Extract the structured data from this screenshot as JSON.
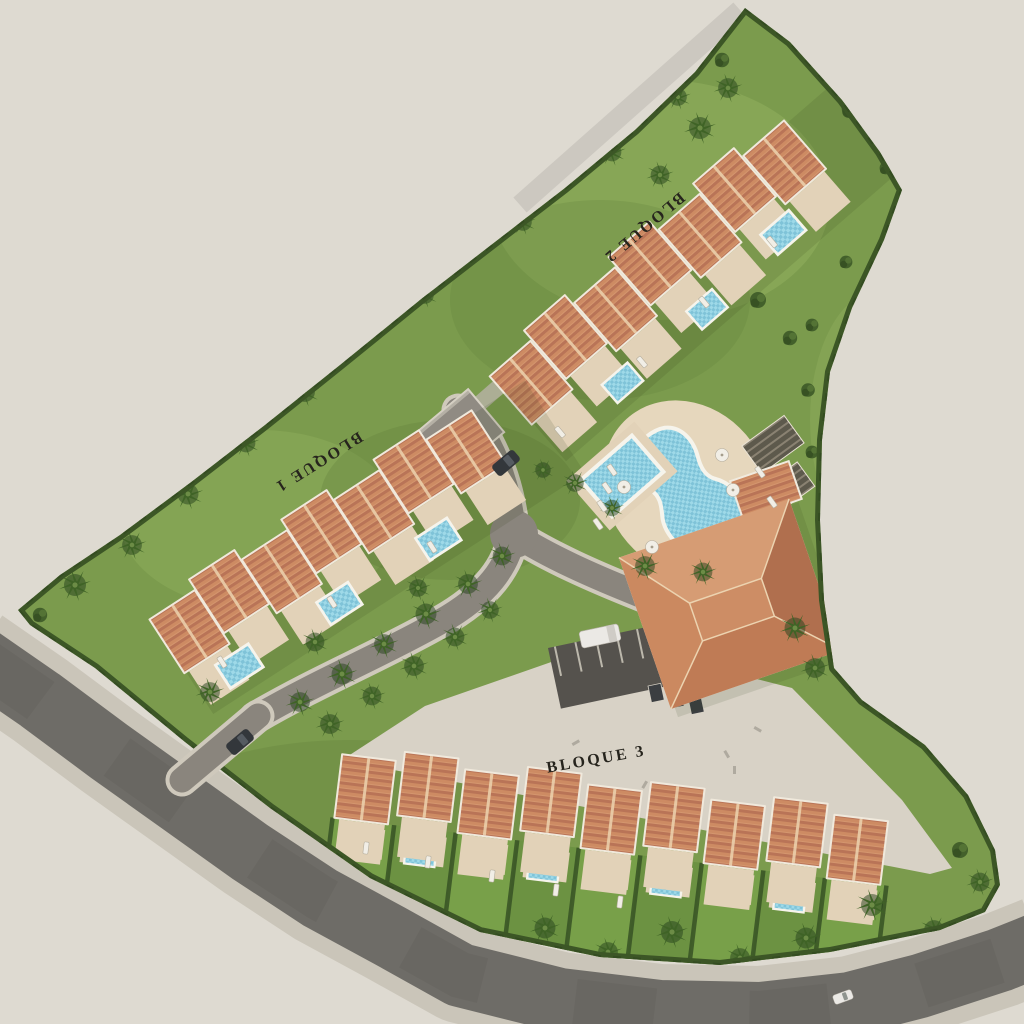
{
  "scene": {
    "type": "aerial-site-plan-3d-render",
    "labels": {
      "block1": "BLOQUE 1",
      "block2": "BLOQUE 2",
      "block3": "BLOQUE 3"
    }
  },
  "icons": {
    "palm_tree_icon": "radial-frond starburst",
    "bush_icon": "green circle cluster",
    "umbrella_icon": "white circle",
    "sun_lounger_icon": "small white rectangle",
    "car_icon": "rounded rectangle"
  },
  "palette": {
    "outside": "#dedad1",
    "grass": "#7b9b4d",
    "grass_light": "#94b160",
    "grass_dark": "#5f7e3a",
    "hedge": "#3c5626",
    "roof": "#cd8b63",
    "roof_shade": "#b97457",
    "roof_ridge": "#ecd2ae",
    "wall": "#f0e9dc",
    "terrace": "#e2d2b8",
    "pool_water": "#9ed9e8",
    "pool_water_deep": "#7fc3d8",
    "pool_rim": "#f6f4ec",
    "road_asphalt": "#6e6c67",
    "sidewalk": "#cac5b9",
    "driveway": "#8a857d",
    "driveway_curb": "#cfc9bc",
    "plaza": "#d8d2c6",
    "parking_asphalt": "#55524d",
    "pergola": "#5d594c",
    "pergola_slat": "#8a8272",
    "car_dark": "#33373b",
    "car_white": "#ebe9e5",
    "label_ink": "#26241d"
  }
}
